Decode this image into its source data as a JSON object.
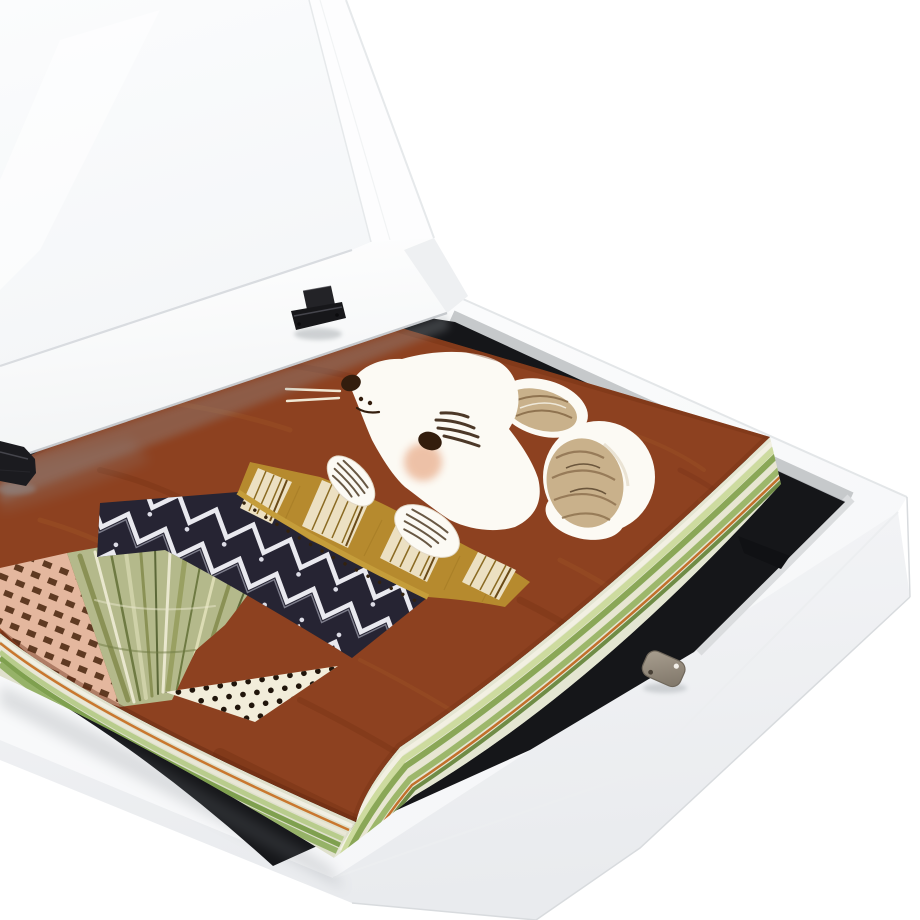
{
  "scene": {
    "subject": "white wooden art display frame box, lid open",
    "objects": {
      "lid": "hinged white frame lid with glass pane, tilted open",
      "base": "white frame base box with black felt interior",
      "stack": "thick stack of art papers with green layered edges",
      "artwork": "children's illustration of a white mouse in bed under patterned blanket on rust background",
      "hinges": "two black metal hinges",
      "magnet": "small metal magnetic catch on front ledge"
    },
    "artwork_motifs": [
      "white mouse head",
      "round beige ears",
      "whiskers",
      "rosy cheek",
      "two white paws",
      "gold striped blanket band",
      "navy zigzag chevron band",
      "green striped wedge",
      "polka-dot folded corner",
      "pink dashed band"
    ]
  },
  "palette": {
    "bg": "#ffffff",
    "glass_top": "#fbfcfd",
    "glass_bottom": "#f4f6f8",
    "lid_white": "#fdfdfe",
    "lid_edge": "#e6e9eb",
    "lid_inner_edge": "#d9dce0",
    "rail_top": "#ffffff",
    "rail_bottom": "#f2f4f5",
    "rail_bottom_line": "#c6c9cd",
    "rail_end": "#eef0f2",
    "base_top": "#fcfdfd",
    "base_top2": "#f5f6f8",
    "base_side": "#f4f5f7",
    "base_side2": "#e9ebee",
    "base_far_line": "#e3e6e8",
    "base_crease": "#eceef0",
    "base_outline": "#d8dbde",
    "bevel": "#c6c9cb",
    "bevel_dark": "#aaadb1",
    "bevel_light": "#dadcde",
    "black": "#151619",
    "seam": "#3f4146",
    "notch": "#101114",
    "shadow": "#8f959a",
    "shadow_soft": "#7a8086",
    "stack_left_base": "#dfe0cc",
    "stack_right_base": "#e4e6d2",
    "s_cream": "#f1efe3",
    "s_cream2": "#e9e7d6",
    "s_cream3": "#f2f0e2",
    "s_cream4": "#e8e6d2",
    "s_green_l": "#b8cc8c",
    "s_green_l2": "#cddb9f",
    "s_green": "#7fa04f",
    "s_green2": "#8aa757",
    "s_green3": "#96b268",
    "s_green4": "#9db76b",
    "s_green_d": "#6f8c46",
    "s_orange": "#c9772e",
    "s_orange2": "#c2702c",
    "rust": "#8d4120",
    "rust_dark": "#6f2d12",
    "rust_deep": "#5f2610",
    "rust_light": "#a25829",
    "mouse": "#fcfaf4",
    "mouse_shade": "#e2d8c6",
    "ink": "#331d0d",
    "hatch": "#3a2412",
    "blush": "#e08a5c",
    "whisker": "#f0e8d4",
    "ear_beige": "#c9b18b",
    "scribble": "#8f7350",
    "scribble_dark": "#6b563c",
    "scribble_light": "#efe9da",
    "gold": "#b68a2e",
    "gold_line": "#a37a24",
    "cream": "#ece0c2",
    "patch_line": "#8a6a22",
    "patch_dark": "#6a4a16",
    "trim": "#c59d3a",
    "trim_dot": "#33220e",
    "navy": "#262433",
    "zig": "#e9e9ef",
    "zig_dim": "#b9bac8",
    "navy_dot": "#dcdce6",
    "wedge": "#b4b98b",
    "w1": "#8a9155",
    "w2": "#e9e7ce",
    "w3": "#6e7a42",
    "w4": "#cfd1a8",
    "w5": "#5c6838",
    "w6": "#99a062",
    "w7": "#dcdcb4",
    "polka": "#f2edda",
    "polka_dot": "#20150b",
    "pink": "#e4b79e",
    "pink_dash": "#5f3a22",
    "paw_line": "#4f3c26",
    "hinge": "#1b1b1f",
    "hinge_dark": "#17171a",
    "hinge_plate": "#232327",
    "hinge_hl": "#45454c",
    "hinge_pin": "#0b0b0d",
    "mag1": "#aaa091",
    "mag2": "#7d7467",
    "mag_edge": "#6f675b",
    "mag_dot": "#f2efe9",
    "mag_hole": "#473f35"
  }
}
